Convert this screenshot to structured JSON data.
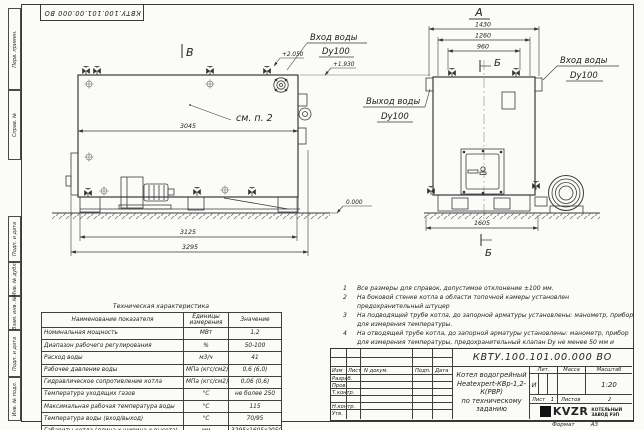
{
  "frame": {
    "doc_number_top": "КВТУ.100.101.00.000 ВО",
    "left_strip": [
      "Перв. примен.",
      "Справ. №",
      "Подп. и дата",
      "Инв. № дубл.",
      "Взам. инв. №",
      "Подп. и дата",
      "Инв. № подл."
    ],
    "format_label": "Формат",
    "format_value": "А3"
  },
  "drawing": {
    "side_view": {
      "view_mark": "В",
      "see_note": "см. п. 2",
      "dim_inner_length": "3045",
      "dim_base_length": "3125",
      "dim_overall_length": "3295",
      "elev_nozzle": "+2.050",
      "elev_pipe": "+1.930",
      "elev_ground": "0.000",
      "inlet_line1": "Вход воды",
      "inlet_line2": "Dy100"
    },
    "front_view": {
      "view_mark": "А",
      "section_mark_top": "Б",
      "section_mark_bottom": "Б",
      "dim_overall_width": "1430",
      "dim_mid_width": "1260",
      "dim_inner_width": "960",
      "dim_base_width": "1605",
      "inlet_line1": "Вход воды",
      "inlet_line2": "Dy100",
      "outlet_line1": "Выход воды",
      "outlet_line2": "Dy100"
    }
  },
  "notes": [
    {
      "num": "1",
      "text": "Все размеры для справок, допустимое отклонение ±100 мм."
    },
    {
      "num": "2",
      "text": "На боковой стенке котла в области топочной камеры установлен предохранительный штуцер"
    },
    {
      "num": "3",
      "text": "На подводящей трубе котла, до запорной арматуры установлены: манометр, прибор для измерения температуры."
    },
    {
      "num": "4",
      "text": "На отводящей трубе котла, до запорной арматуры установлены: манометр, прибор для измерения температуры, предохранительный клапан Dу не менее 50 мм и отвод с обратным клапаном Dу не менее 50 мм."
    }
  ],
  "spec_table": {
    "title": "Техническая характеристика",
    "col_name": "Наименование показателя",
    "col_units": "Единицы измерения",
    "col_value": "Значение",
    "rows": [
      {
        "name": "Номинальная мощность",
        "units": "МВт",
        "value": "1,2"
      },
      {
        "name": "Диапазон рабочего регулирования",
        "units": "%",
        "value": "50-100"
      },
      {
        "name": "Расход воды",
        "units": "м3/ч",
        "value": "41"
      },
      {
        "name": "Рабочее давление воды",
        "units": "МПа (кгс/см2)",
        "value": "0,6 (6,0)"
      },
      {
        "name": "Гидравлическое сопротивление котла",
        "units": "МПа (кгс/см2)",
        "value": "0,06 (0,6)"
      },
      {
        "name": "Температура уходящих газов",
        "units": "°С",
        "value": "не более 250"
      },
      {
        "name": "Максимальная рабочая температура воды",
        "units": "°С",
        "value": "115"
      },
      {
        "name": "Температура воды (вход/выход)",
        "units": "°С",
        "value": "70/95"
      },
      {
        "name": "Габариты котла (длина х ширина х высота)",
        "units": "мм",
        "value": "3295х1605х2050"
      }
    ]
  },
  "title_block": {
    "doc_number": "КВТУ.100.101.00.000 ВО",
    "rev_headers": {
      "izm": "Изм",
      "list": "Лист",
      "doc": "N докум.",
      "podp": "Подп.",
      "data": "Дата"
    },
    "roles": {
      "r1": "Разраб.",
      "r2": "Пров.",
      "r3": "Т.контр.",
      "r4": "Н.контр.",
      "r5": "Утв."
    },
    "product_line1": "Котел водогрейный",
    "product_line2": "Heatexpert-КВр-1,2-К(РВР)",
    "product_line3": "по техническому заданию",
    "lit_label": "Лит.",
    "lit_value": "И",
    "mass_label": "Масса",
    "scale_label": "Масштаб",
    "scale_value": "1:20",
    "sheet_label": "Лист",
    "sheet_value": "1",
    "sheets_label": "Листов",
    "sheets_value": "2",
    "logo_text": "KVZR",
    "company_line1": "КОТЕЛЬНЫЙ",
    "company_line2": "ЗАВОД РЭП"
  }
}
